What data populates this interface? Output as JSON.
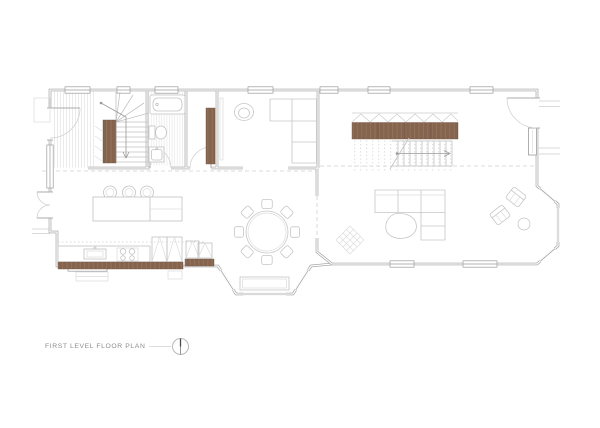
{
  "sheet": {
    "background": "#ffffff"
  },
  "title_block": {
    "label": "FIRST LEVEL FLOOR PLAN",
    "marker": "north-orientation-marker"
  },
  "colors": {
    "background": "#ffffff",
    "wall": "#9c9c9c",
    "fixture": "#c2c2c2",
    "furniture": "#c6c6c6",
    "wood": "#85644e",
    "wood_grain": "#a1806a",
    "wood_edge": "#6b4f3d",
    "hatch": "#e3e3e3",
    "dash": "#cfcfcf",
    "text": "#8d8d8d",
    "marker_line": "#dddddd",
    "marker_needle": "#4a4a4a"
  }
}
